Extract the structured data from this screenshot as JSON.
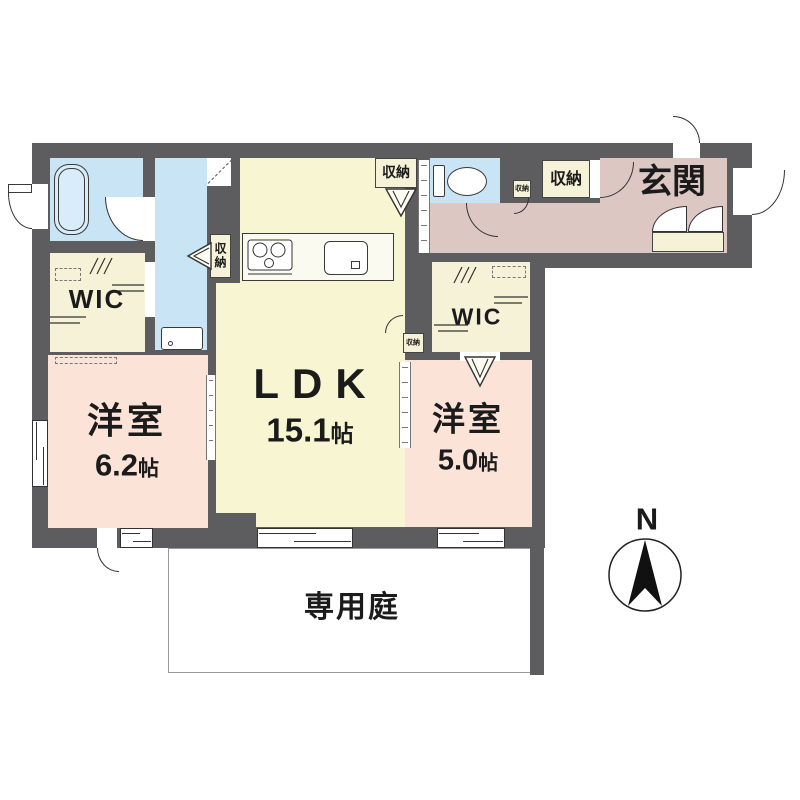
{
  "plan": {
    "ldk": {
      "label": "LDK",
      "size_num": "15.1",
      "size_unit": "帖"
    },
    "room_west_1": {
      "label": "洋室",
      "size_num": "6.2",
      "size_unit": "帖"
    },
    "room_west_2": {
      "label": "洋室",
      "size_num": "5.0",
      "size_unit": "帖"
    },
    "entrance_label": "玄関",
    "wic_label": "WIC",
    "storage_label": "収納",
    "garden_label": "専用庭",
    "compass_north": "N",
    "colors": {
      "wall": "#5d5d5f",
      "ldk_fill": "#f8f6d2",
      "western_room_fill": "#fbe3d8",
      "hall_entrance_fill": "#dcc7c3",
      "water_area_fill": "#c8e4f5",
      "storage_fill": "#f5f2d8",
      "garden_border": "#999999"
    }
  }
}
